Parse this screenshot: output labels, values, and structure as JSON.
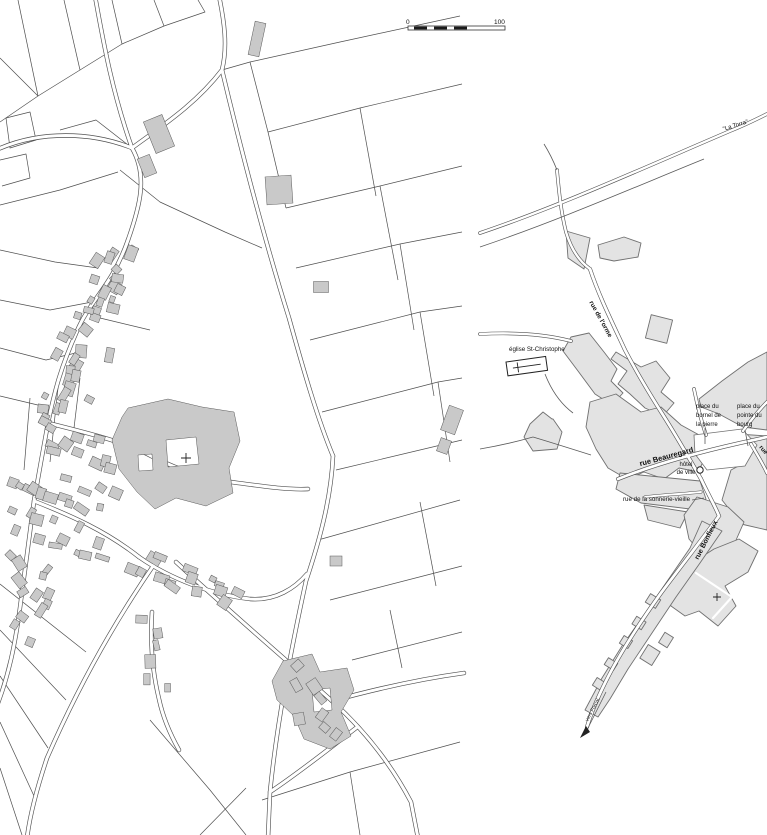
{
  "colors": {
    "paper": "#ffffff",
    "parcel_line": "#4f4f4f",
    "building_fill": "#c9c9c9",
    "block_fill": "#e3e3e3",
    "block_outline": "#707070",
    "road_casing": "#4f4f4f",
    "label": "#111111"
  },
  "scale_bar": {
    "start": "0",
    "end": "100"
  },
  "right_map": {
    "labels": {
      "la_torra": "\"La Torra\"",
      "rue_de_lorme": "rue de l'orme",
      "eglise": "église St-Christophe",
      "place_bornel": [
        "place du",
        "bornel de",
        "la pierre"
      ],
      "place_pointe": [
        "place du",
        "pointe du",
        "bourg"
      ],
      "rue_beauregard": "rue Beauregard",
      "hotel_de_ville": [
        "hôtel",
        "de ville"
      ],
      "rue_sonnerie": "rue de la sonnerie-vieille",
      "rue_bonfieux": "rue Bonfieux",
      "rue_partial": "rue",
      "vers": "vers Forcal."
    }
  }
}
